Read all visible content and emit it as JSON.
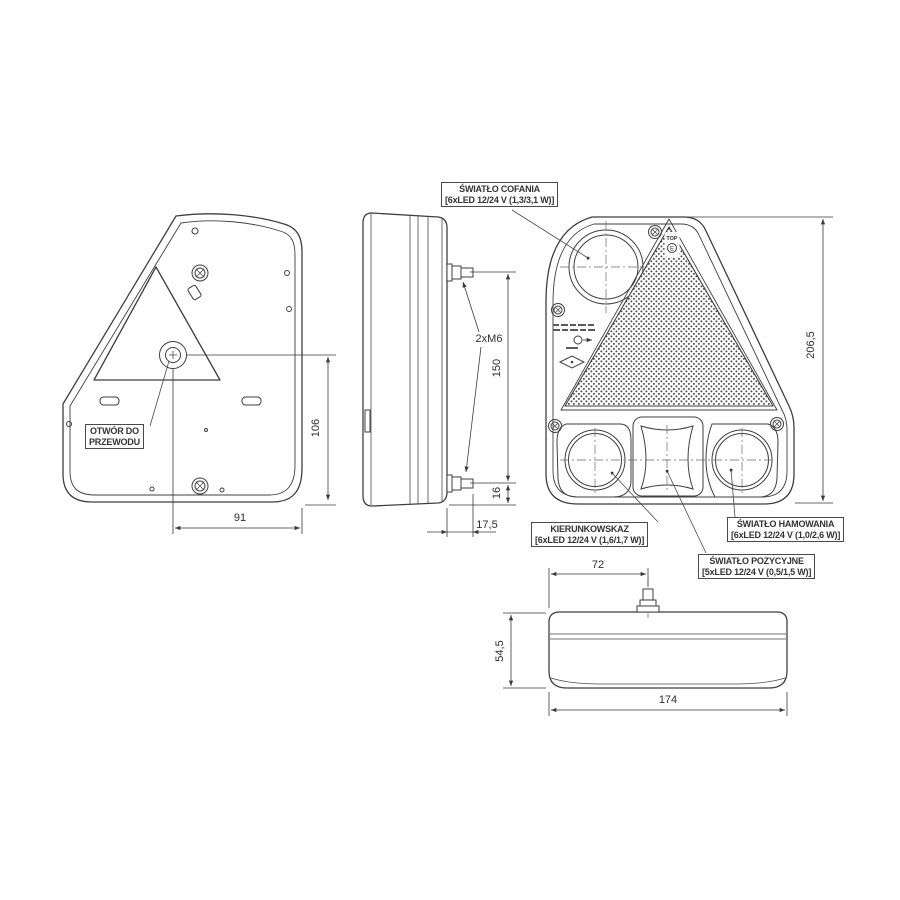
{
  "drawing": {
    "background": "#ffffff",
    "line_color": "#3f3f3f",
    "callouts": {
      "reversing": {
        "line1": "ŚWIATŁO COFANIA",
        "line2": "[6xLED 12/24 V (1,3/3,1 W)]"
      },
      "turn": {
        "line1": "KIERUNKOWSKAZ",
        "line2": "[6xLED 12/24 V (1,6/1,7 W)]"
      },
      "brake": {
        "line1": "ŚWIATŁO HAMOWANIA",
        "line2": "[6xLED 12/24 V (1,0/2,6 W)]"
      },
      "position": {
        "line1": "ŚWIATŁO POZYCYJNE",
        "line2": "[5xLED 12/24 V (0,5/1,5 W)]"
      },
      "cable_hole": {
        "line1": "OTWÓR DO",
        "line2": "PRZEWODU"
      },
      "bolt_spec": "2xM6"
    },
    "dimensions": {
      "back_hole_to_edge": "91",
      "back_hole_to_bottom": "106",
      "side_bolt_spacing": "150",
      "side_bolt_to_bottom": "16",
      "side_bolt_length": "17,5",
      "front_total_height": "206,5",
      "top_bolt_offset": "72",
      "top_depth": "54,5",
      "top_total_width": "174"
    },
    "reflector_marks": {
      "top": "TOP",
      "e_mark": "E"
    }
  }
}
